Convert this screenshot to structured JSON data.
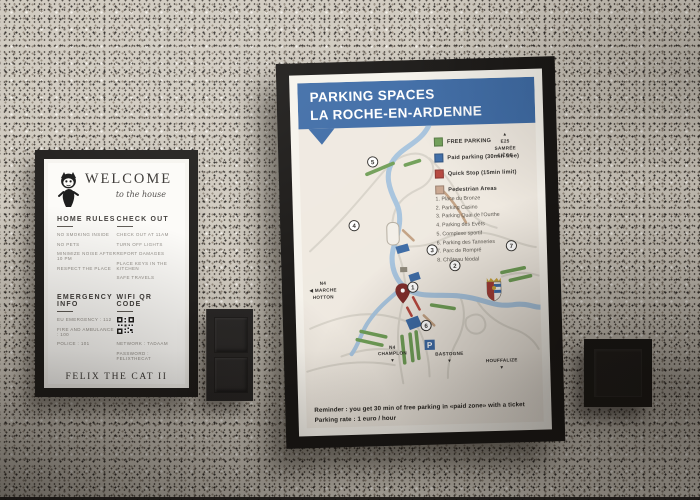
{
  "welcome_sign": {
    "title": "WELCOME",
    "subtitle": "to the house",
    "home_rules": {
      "heading": "HOME RULES",
      "items": [
        "NO SMOKING INSIDE",
        "NO PETS",
        "MINIMIZE NOISE AFTER 10 PM",
        "RESPECT THE PLACE"
      ]
    },
    "check_out": {
      "heading": "CHECK OUT",
      "items": [
        "CHECK OUT AT 11AM",
        "TURN OFF LIGHTS",
        "REPORT DAMAGES",
        "PLACE KEYS IN THE KITCHEN",
        "SAFE TRAVELS"
      ]
    },
    "emergency": {
      "heading": "EMERGENCY INFO",
      "items": [
        "EU EMERGENCY : 112",
        "FIRE AND AMBULANCE : 100",
        "POLICE : 101"
      ]
    },
    "wifi": {
      "heading": "WIFI QR CODE",
      "network": "NETWORK : TADAAM",
      "password": "PASSWORD : FELIXTHECAT"
    },
    "property_name": "FELIX THE CAT II",
    "thanks": "THANK YOU FOR CHOOSING TO STAY WITH US",
    "phone1": "PHONE : +32 471 07 51 80",
    "phone2": "+32 489 85 49 56",
    "email": "EMAIL : INFO@LAROCHE.COM"
  },
  "parking_poster": {
    "title_line1": "PARKING SPACES",
    "title_line2": "LA ROCHE-EN-ARDENNE",
    "banner_color": "#3c6aa5",
    "legend": [
      {
        "label": "FREE PARKING",
        "color": "#6f9e56"
      },
      {
        "label": "Paid parking (30min free)",
        "color": "#3c6aa5"
      },
      {
        "label": "Quick Stop (15min limit)",
        "color": "#b5453c"
      },
      {
        "label": "Pedestrian Areas",
        "color": "#c9a68f"
      }
    ],
    "locations": [
      "1. Place du Bronze",
      "2. Parking Casino",
      "3. Parking Quai de l'Ourthe",
      "4. Parking des Evêts",
      "5. Complexe sportif",
      "6. Parking des Tanneries",
      "7. Parc de Rompré",
      "8. Château féodal"
    ],
    "map_markers": [
      "1",
      "2",
      "3",
      "4",
      "5",
      "6",
      "7"
    ],
    "p_symbol": "P",
    "directions": {
      "e25": "▲\nE25\nSAMRÉE\nLIÈGE",
      "marche": "N4\n◀ MARCHE\nHOTTON",
      "champlon": "N4\nCHAMPLON\n▼",
      "bastogne": "BASTOGNE\n▼",
      "houffalize": "HOUFFALIZE\n▼"
    },
    "reminder_line1": "Reminder : you get 30 min of free parking in «paid zone» with a ticket",
    "reminder_line2": "Parking rate : 1 euro / hour",
    "river_color": "#a6c3dd",
    "pin_color": "#7e2a28"
  },
  "switches": {
    "middle": "double-rocker-light-switch",
    "right": "single-light-switch"
  },
  "wall_color": "#cfc9be"
}
